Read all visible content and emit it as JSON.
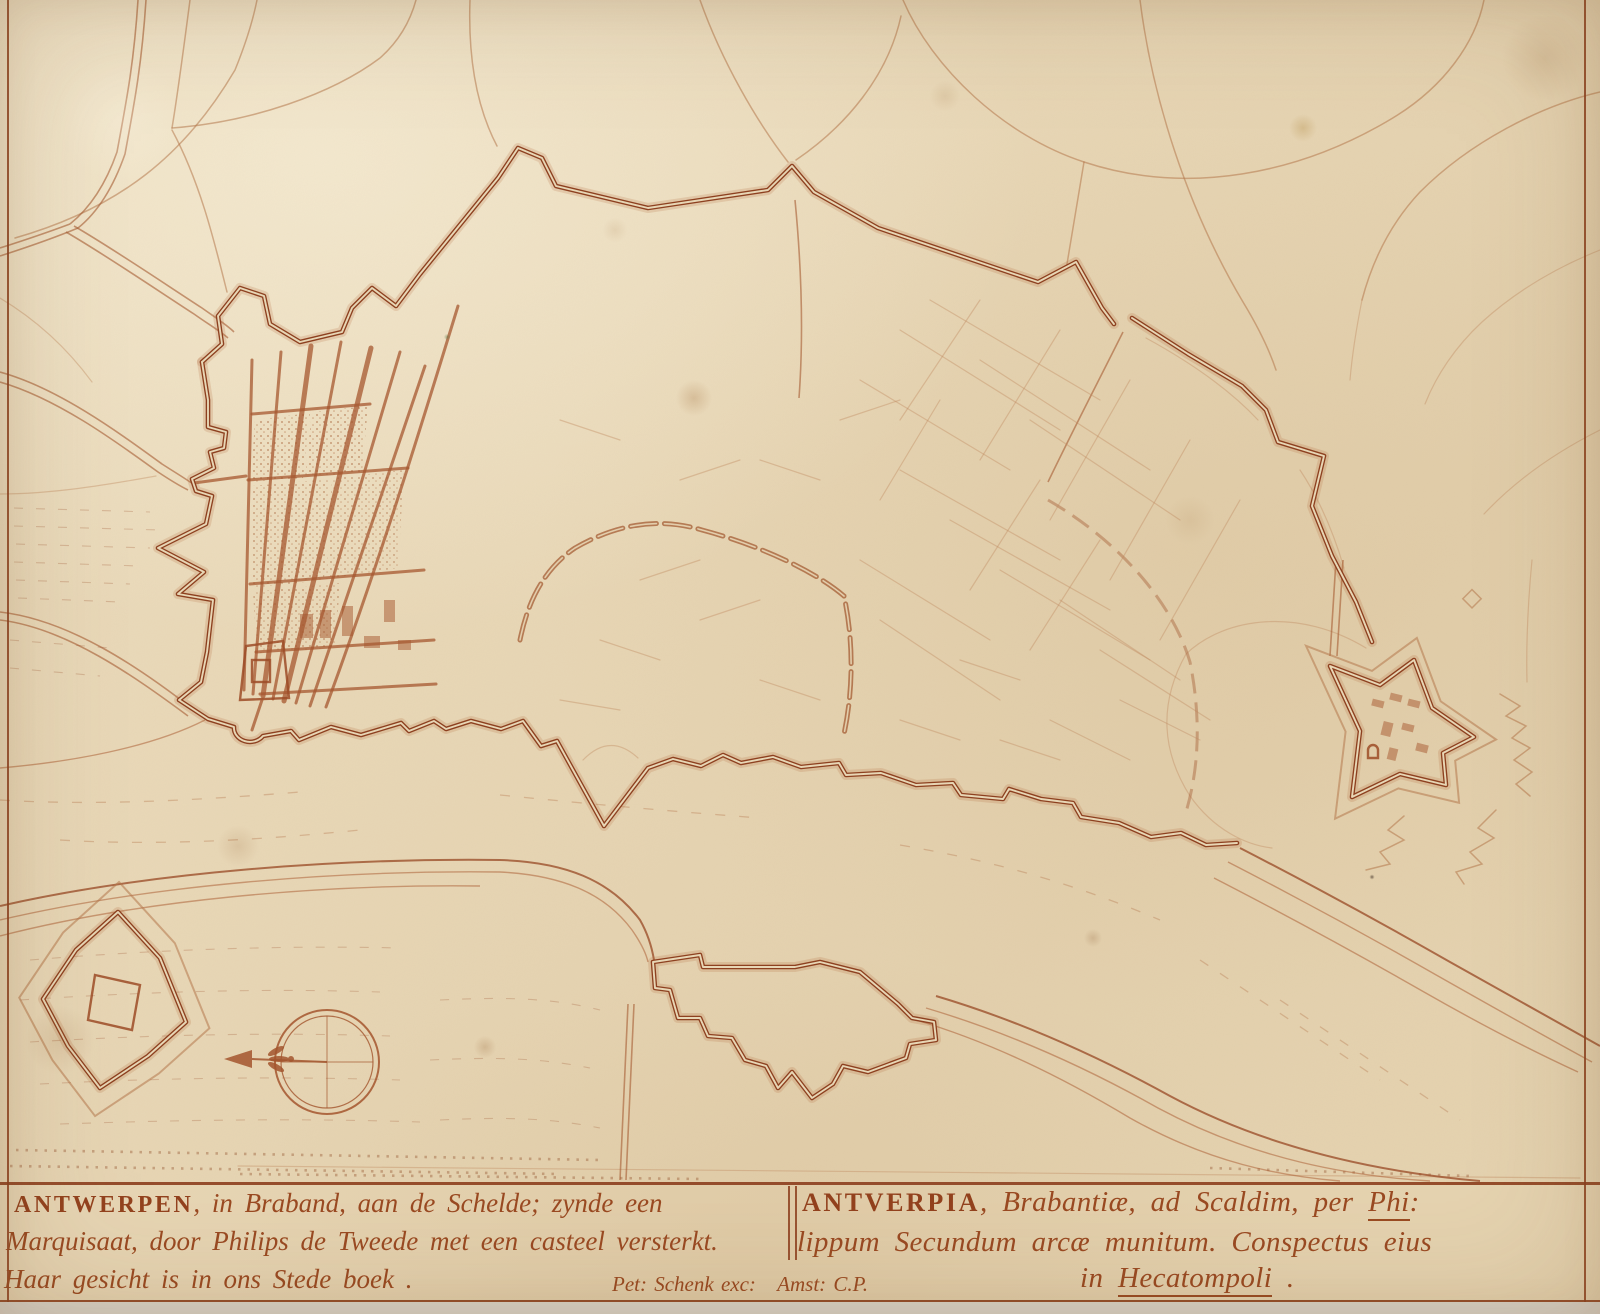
{
  "artwork": {
    "kind": "engraved-fortification-plan",
    "subject": "Antwerp",
    "ink_color": "#9a4a22",
    "paper_color": "#e7d6b5"
  },
  "title_band": {
    "dutch": {
      "city_caps": "ANTWERPEN",
      "line1_rest": ", in Braband, aan de Schelde; zynde een",
      "line2": "Marquisaat, door Philips de Tweede met een casteel versterkt.",
      "line3": "Haar gesicht is in ons Stede boek ."
    },
    "imprint": {
      "left": "Pet: Schenk exc:",
      "right": "Amst: C.P."
    },
    "latin": {
      "city_caps": "ANTVERPIA",
      "line1_mid": ", Brabantiæ, ad Scaldim, per ",
      "line1_underlined": "Phi",
      "line1_end": ":",
      "line2": "lippum Secundum arcæ munitum. Conspectus eius",
      "line3_prefix": "in ",
      "line3_underlined": "Hecatompoli",
      "line3_end": " ."
    }
  },
  "map_features": {
    "city_wall": "bastioned-city-wall",
    "citadel": "pentagonal-citadel",
    "river": "scheldt-river",
    "star_fort": "star-fort-left-bank",
    "hornwork": "hornwork-fort",
    "compass": "compass-rose-with-fleur-de-lis"
  }
}
